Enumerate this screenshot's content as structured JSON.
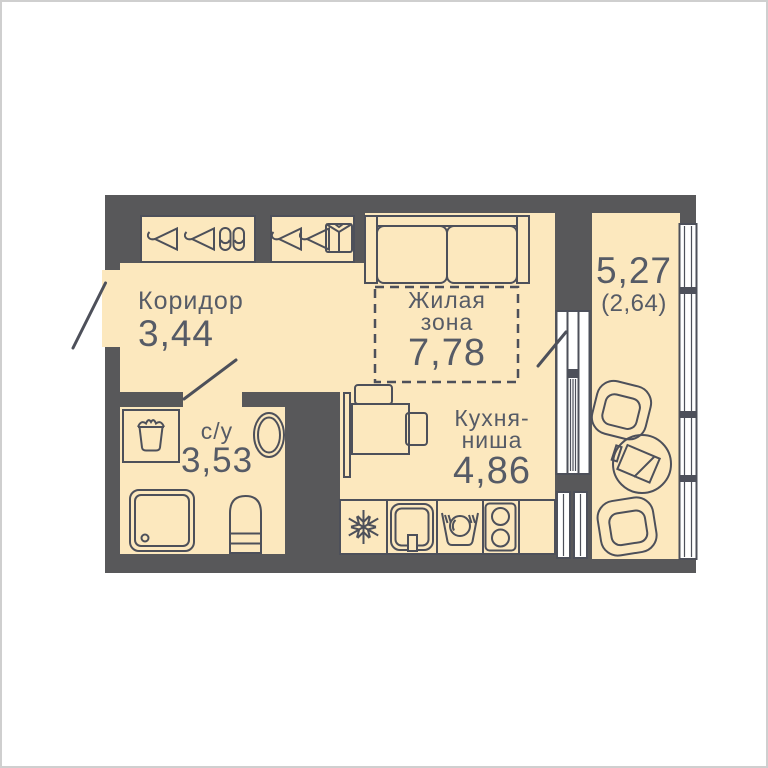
{
  "colors": {
    "floor": "#FCE8BE",
    "wall": "#58585A",
    "line": "#4D505A",
    "text": "#565B66",
    "window": "#FFFFFF",
    "background": "#FFFFFF",
    "frame": "#CFCFCF"
  },
  "rooms": {
    "corridor": {
      "name": "Коридор",
      "area": "3,44"
    },
    "living": {
      "name_line1": "Жилая",
      "name_line2": "зона",
      "area": "7,78"
    },
    "kitchen": {
      "name_line1": "Кухня-",
      "name_line2": "ниша",
      "area": "4,86"
    },
    "bathroom": {
      "name": "с/у",
      "area": "3,53"
    },
    "balcony": {
      "area_total": "5,27",
      "area_counted": "(2,64)"
    }
  },
  "icons": [
    "hanger-icon",
    "slippers-icon",
    "shirt-icon",
    "snowflake-fridge-icon",
    "kitchen-sink-icon",
    "dishwashing-icon",
    "cooktop-icon",
    "laundry-basket-icon"
  ]
}
